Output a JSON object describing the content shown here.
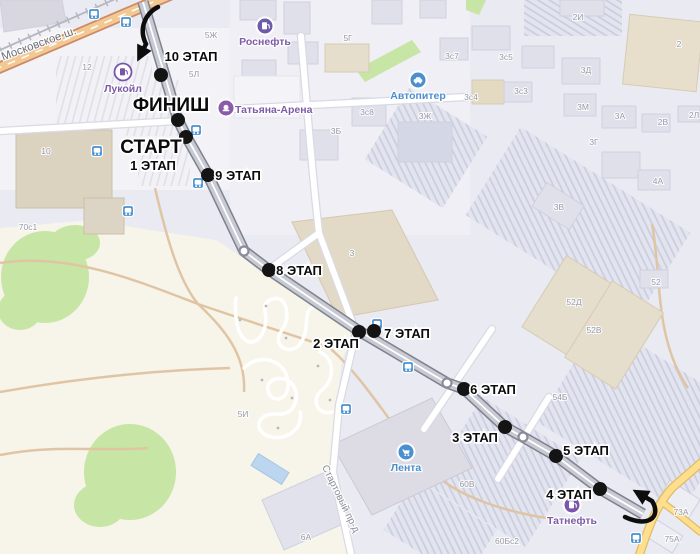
{
  "map": {
    "colors": {
      "background": "#e9eaf2",
      "open_land": "#f7f4ea",
      "park": "#c7e5a4",
      "route_road_casing": "#7f828d",
      "route_road_fill": "#c7c9d3",
      "highway_fill": "#f2c893",
      "yellow_road_fill": "#ffde8d",
      "stage_dot": "#141414",
      "bus_icon": "#4a90ce",
      "poi_purple": "#7a55a8",
      "poi_blue": "#4a90ce",
      "annotation_arrow": "#0d0d0d"
    },
    "route": {
      "points": [
        [
          143,
          2
        ],
        [
          178,
          120
        ],
        [
          186,
          136
        ],
        [
          208,
          175
        ],
        [
          244,
          251
        ],
        [
          269,
          270
        ],
        [
          300,
          291
        ],
        [
          359,
          331
        ],
        [
          447,
          383
        ],
        [
          464,
          389
        ],
        [
          505,
          427
        ],
        [
          523,
          437
        ],
        [
          556,
          456
        ],
        [
          600,
          489
        ],
        [
          643,
          514
        ]
      ],
      "circle_markers": [
        [
          244,
          251
        ],
        [
          447,
          383
        ],
        [
          523,
          437
        ]
      ]
    },
    "stages": [
      {
        "label": "10 ЭТАП",
        "lx": 191,
        "ly": 61,
        "size": 13,
        "dx": 161,
        "dy": 75
      },
      {
        "label": "ФИНИШ",
        "lx": 171,
        "ly": 111,
        "size": 19,
        "dx": 178,
        "dy": 120
      },
      {
        "label": "СТАРТ",
        "lx": 151,
        "ly": 153,
        "size": 19,
        "dx": 186,
        "dy": 137
      },
      {
        "label": "1 ЭТАП",
        "lx": 153,
        "ly": 170,
        "size": 13
      },
      {
        "label": "9 ЭТАП",
        "lx": 238,
        "ly": 180,
        "size": 13,
        "dx": 208,
        "dy": 175
      },
      {
        "label": "8 ЭТАП",
        "lx": 299,
        "ly": 275,
        "size": 13,
        "dx": 269,
        "dy": 270
      },
      {
        "label": "2 ЭТАП",
        "lx": 336,
        "ly": 348,
        "size": 13,
        "dx": 359,
        "dy": 332
      },
      {
        "label": "7 ЭТАП",
        "lx": 407,
        "ly": 338,
        "size": 13,
        "dx": 374,
        "dy": 331
      },
      {
        "label": "6 ЭТАП",
        "lx": 493,
        "ly": 394,
        "size": 13,
        "dx": 464,
        "dy": 389
      },
      {
        "label": "3 ЭТАП",
        "lx": 475,
        "ly": 442,
        "size": 13,
        "dx": 505,
        "dy": 427
      },
      {
        "label": "5 ЭТАП",
        "lx": 586,
        "ly": 455,
        "size": 13,
        "dx": 556,
        "dy": 456
      },
      {
        "label": "4 ЭТАП",
        "lx": 569,
        "ly": 499,
        "size": 13,
        "dx": 600,
        "dy": 489
      }
    ],
    "street_names": [
      {
        "text": "Московское ш.",
        "x": 40,
        "y": 47,
        "rotate": -20,
        "size": 11.5,
        "color": "#6e6f78"
      },
      {
        "text": "Стартовый пр-д",
        "x": 338,
        "y": 500,
        "rotate": 64,
        "size": 10,
        "color": "#8c8d96"
      }
    ],
    "pois": [
      {
        "name": "Лукойл",
        "icon": "fuel",
        "variant": "outline",
        "color": "#7a55a8",
        "text_color": "#7d5ba6",
        "x": 123,
        "y": 72,
        "label_x": 123,
        "label_y": 92
      },
      {
        "name": "Роснефть",
        "icon": "fuel",
        "variant": "fill",
        "color": "#6f5ba7",
        "text_color": "#7d5ba6",
        "x": 265,
        "y": 26,
        "label_x": 265,
        "label_y": 45
      },
      {
        "name": "Татьяна-Арена",
        "icon": "arena",
        "variant": "fill",
        "color": "#8a5ba8",
        "text_color": "#7d5ba6",
        "x": 226,
        "y": 108,
        "label_x": 235,
        "label_y": 113,
        "anchor": "start"
      },
      {
        "name": "Автопитер",
        "icon": "car",
        "variant": "fill",
        "color": "#4a90ce",
        "text_color": "#4c8fcc",
        "x": 418,
        "y": 80,
        "label_x": 418,
        "label_y": 99
      },
      {
        "name": "Лента",
        "icon": "cart",
        "variant": "fill",
        "color": "#4a90ce",
        "text_color": "#4c8fcc",
        "x": 406,
        "y": 452,
        "label_x": 406,
        "label_y": 471
      },
      {
        "name": "Татнефть",
        "icon": "fuel",
        "variant": "fill",
        "color": "#7a55a8",
        "text_color": "#7d5ba6",
        "x": 572,
        "y": 505,
        "label_x": 572,
        "label_y": 524
      }
    ],
    "bus_stops": [
      {
        "x": 94,
        "y": 14
      },
      {
        "x": 126,
        "y": 22
      },
      {
        "x": 97,
        "y": 151
      },
      {
        "x": 196,
        "y": 130
      },
      {
        "x": 198,
        "y": 183
      },
      {
        "x": 128,
        "y": 211
      },
      {
        "x": 377,
        "y": 324
      },
      {
        "x": 346,
        "y": 409
      },
      {
        "x": 408,
        "y": 367
      },
      {
        "x": 636,
        "y": 538
      }
    ],
    "building_labels": [
      {
        "text": "12",
        "x": 87,
        "y": 70
      },
      {
        "text": "10",
        "x": 46,
        "y": 154
      },
      {
        "text": "5Ж",
        "x": 211,
        "y": 38
      },
      {
        "text": "5Л",
        "x": 194,
        "y": 77
      },
      {
        "text": "5Г",
        "x": 348,
        "y": 41
      },
      {
        "text": "3с7",
        "x": 452,
        "y": 59
      },
      {
        "text": "2И",
        "x": 578,
        "y": 20
      },
      {
        "text": "3с5",
        "x": 506,
        "y": 60
      },
      {
        "text": "3Д",
        "x": 586,
        "y": 73
      },
      {
        "text": "2",
        "x": 679,
        "y": 47
      },
      {
        "text": "3с3",
        "x": 521,
        "y": 94
      },
      {
        "text": "3с4",
        "x": 471,
        "y": 100
      },
      {
        "text": "3М",
        "x": 583,
        "y": 110
      },
      {
        "text": "3А",
        "x": 620,
        "y": 119
      },
      {
        "text": "2В",
        "x": 663,
        "y": 125
      },
      {
        "text": "2Л",
        "x": 694,
        "y": 118
      },
      {
        "text": "3с8",
        "x": 367,
        "y": 115
      },
      {
        "text": "3Ж",
        "x": 425,
        "y": 119
      },
      {
        "text": "3Б",
        "x": 336,
        "y": 134
      },
      {
        "text": "3Г",
        "x": 594,
        "y": 145
      },
      {
        "text": "4А",
        "x": 658,
        "y": 184
      },
      {
        "text": "3",
        "x": 352,
        "y": 256
      },
      {
        "text": "3В",
        "x": 559,
        "y": 210
      },
      {
        "text": "52",
        "x": 656,
        "y": 285
      },
      {
        "text": "52Д",
        "x": 574,
        "y": 305
      },
      {
        "text": "52В",
        "x": 594,
        "y": 333
      },
      {
        "text": "70с1",
        "x": 28,
        "y": 230
      },
      {
        "text": "5И",
        "x": 243,
        "y": 417
      },
      {
        "text": "54Б",
        "x": 560,
        "y": 400
      },
      {
        "text": "6А",
        "x": 306,
        "y": 540
      },
      {
        "text": "60В",
        "x": 467,
        "y": 487
      },
      {
        "text": "60Бс2",
        "x": 507,
        "y": 544
      },
      {
        "text": "73А",
        "x": 681,
        "y": 515
      },
      {
        "text": "75А",
        "x": 672,
        "y": 542
      }
    ]
  }
}
